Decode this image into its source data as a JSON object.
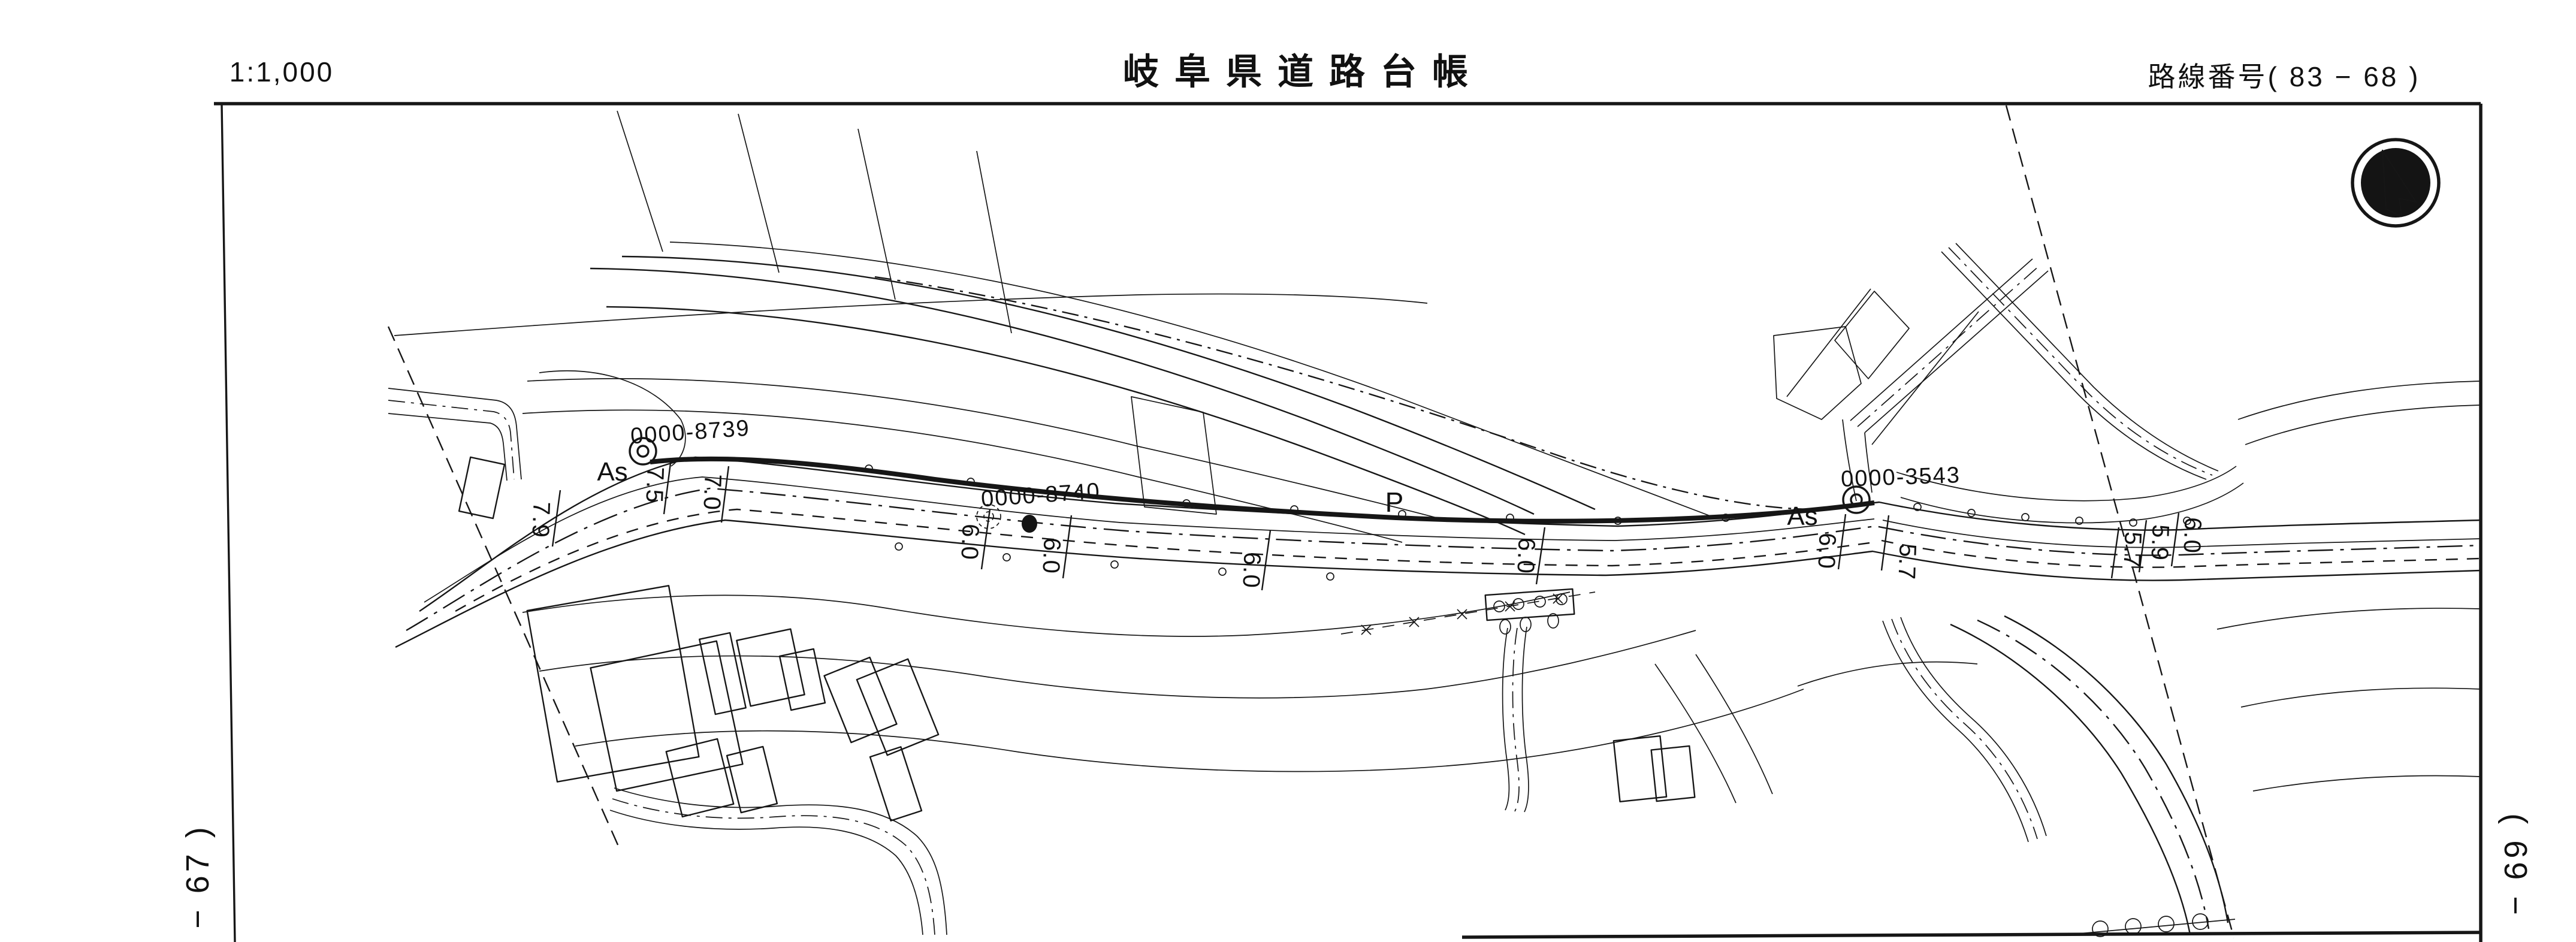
{
  "header": {
    "scale": "1:1,000",
    "title": "岐阜県道路台帳",
    "route_number": "路線番号( 83 − 68 )"
  },
  "sheet_refs": {
    "left": "− 67 )",
    "right": "( 69 −"
  },
  "map": {
    "stations": [
      "0000-8739",
      "0000-8740",
      "0000-3543"
    ],
    "surface_labels": [
      "As",
      "As"
    ],
    "parking_label": "P",
    "widths": [
      "7.9",
      "7.5",
      "7.0",
      "6.0",
      "6.0",
      "6.0",
      "6.0",
      "6.0",
      "5.7",
      "5.7",
      "5.9",
      "6.0"
    ],
    "colors": {
      "ink": "#161616",
      "paper": "#ffffff"
    }
  }
}
